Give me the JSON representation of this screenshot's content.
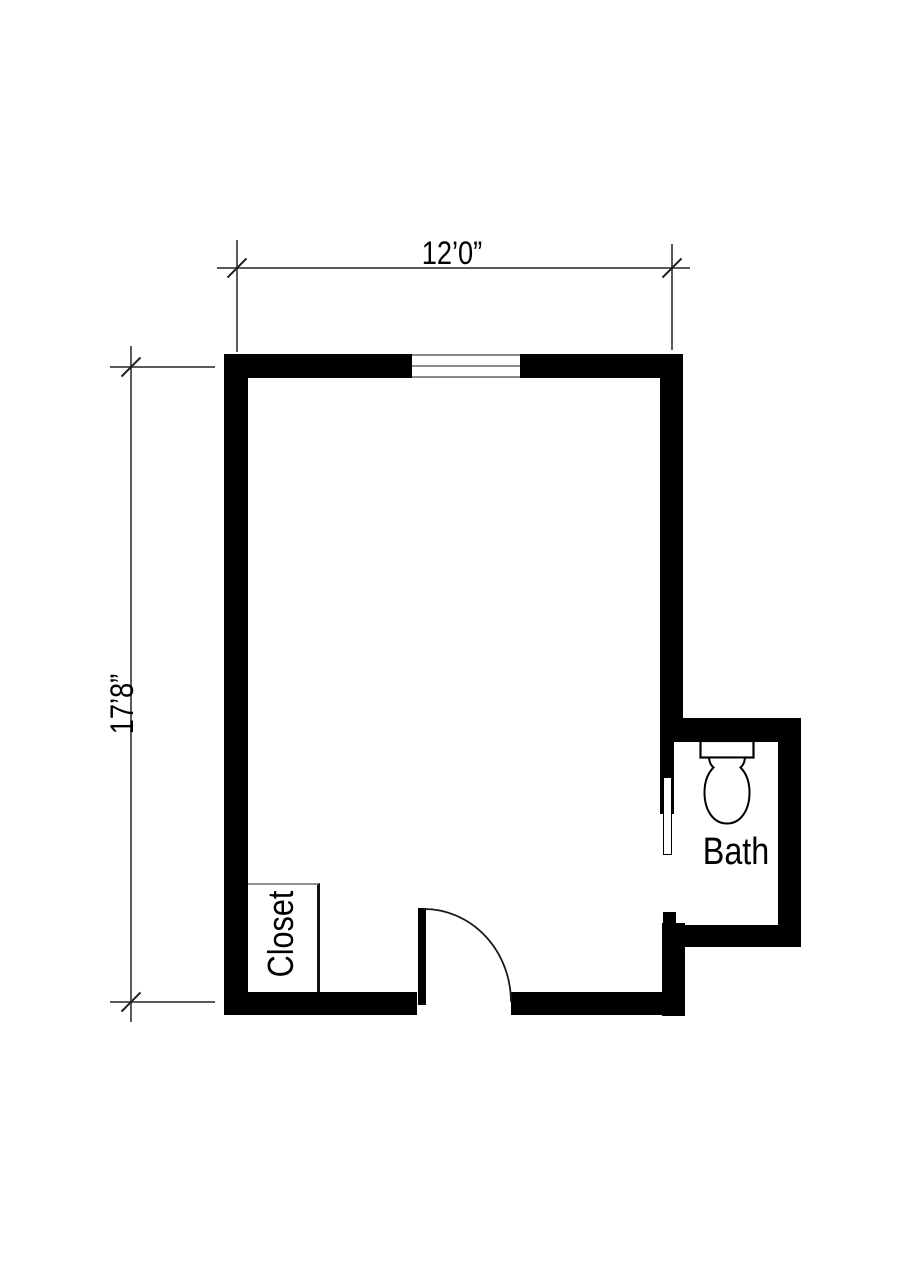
{
  "page": {
    "kind": "architectural floor plan",
    "background": "#ffffff"
  },
  "labels": {
    "width_dimension": "12’0”",
    "height_dimension": "17’8”",
    "bath_room": "Bath",
    "closet_room": "Closet"
  },
  "colors": {
    "wall": "#000000",
    "dimension_line": "#5a5a5a",
    "tick_mark": "#1c1c1c",
    "window_line": "#8a8a8a",
    "text": "#000000",
    "fixture_outline": "#000000"
  },
  "icons": {
    "toilet": "toilet-plan-symbol",
    "door_swing": "quarter-circle-door-swing",
    "door_leaf": "open-door-leaf",
    "window": "double-line-window-symbol",
    "tick": "oblique-dimension-tick"
  }
}
